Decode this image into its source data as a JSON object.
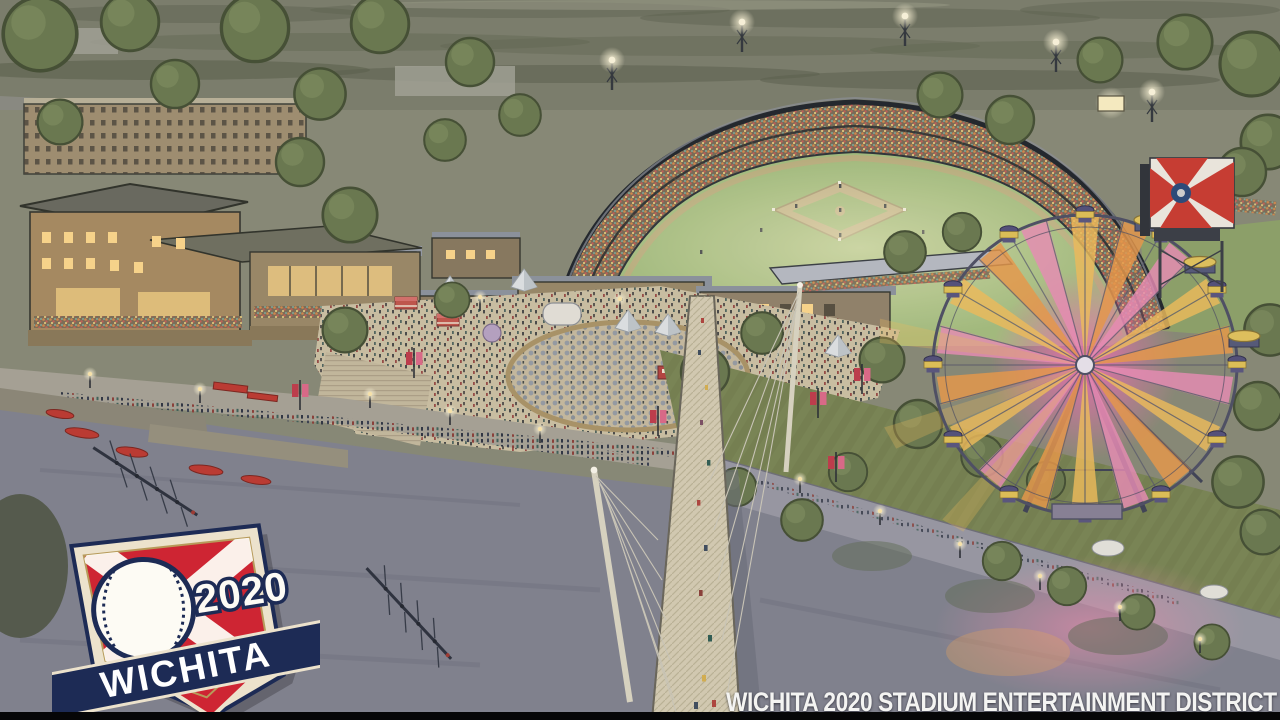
{
  "image": {
    "title": "Aerial dusk watercolor rendering of a riverfront ballpark district",
    "style": "hand-drawn architectural rendering"
  },
  "caption": {
    "text": "WICHITA 2020 STADIUM ENTERTAINMENT DISTRICT"
  },
  "logo": {
    "year": "2020",
    "city": "WICHITA",
    "colors": {
      "navy": "#1d2b55",
      "red": "#ce2533",
      "cream": "#ece2cc",
      "gold": "#b79a5a"
    }
  },
  "scene": {
    "elements": {
      "stadium": "lit baseball stadium with full grandstands and field lights",
      "ferris_wheel": "ferris wheel glowing pink and gold",
      "bridge": "white cable-stayed pedestrian bridge over the river",
      "river": "river with two rowing shells and boat dock",
      "boathouse": "boathouse buildings with warm lit windows",
      "plaza": "festival plaza with tents, umbrellas and crowds",
      "flag_screen": "large Wichita flag billboard",
      "walkway": "tree-lined riverside walkway with lamps and banners"
    },
    "palette": {
      "river": "#82838f",
      "dusk_land": "#7d7f6c",
      "field_green": "#a6bf7e",
      "wheel_pink": "#f070b2",
      "wheel_gold": "#f5c05a",
      "lit_window": "#ffd98c",
      "banner_red": "#c23b4a",
      "caption_white": "#f4f4f2",
      "letterbox_black": "#060607"
    }
  }
}
